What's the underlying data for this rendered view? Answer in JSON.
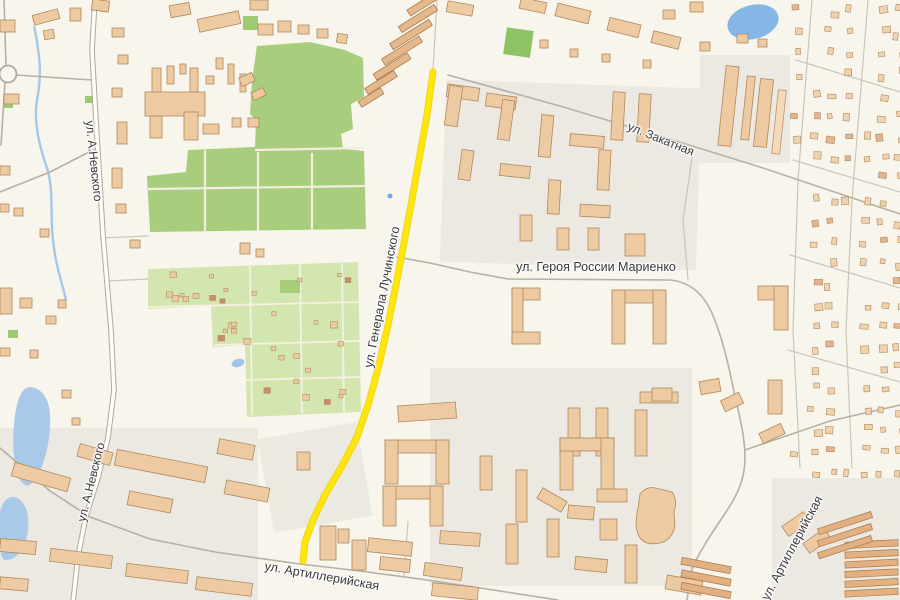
{
  "map": {
    "type": "street-map",
    "palette": {
      "background": "#f8f5ec",
      "residential_tint": "#ebe9e2",
      "park_green": "#a8cd7c",
      "allotment_green": "#d4e6b0",
      "water_blue": "#a9c9e9",
      "building_fill": "#eecaa3",
      "building_stroke": "#b08a5c",
      "road_casing": "#b0a99d",
      "route_highlight": "#ffe400",
      "label_color": "#3a3a3a"
    },
    "highlighted_route": {
      "street": "ул. Генерала Лучинского",
      "color": "#ffe400"
    },
    "street_labels": [
      {
        "id": "a-nevskogo-north",
        "text": "ул. А.Невского",
        "x": 94,
        "y": 161,
        "rotation": 84,
        "font_size": 12
      },
      {
        "id": "a-nevskogo-south",
        "text": "ул. А.Невского",
        "x": 91,
        "y": 482,
        "rotation": -76,
        "font_size": 12
      },
      {
        "id": "generala-luchinskogo",
        "text": "ул. Генерала Лучинского",
        "x": 382,
        "y": 297,
        "rotation": -79,
        "font_size": 12.5
      },
      {
        "id": "zakatnaya",
        "text": "ул. Закатная",
        "x": 661,
        "y": 139,
        "rotation": 22,
        "font_size": 12
      },
      {
        "id": "geroya-rossii-marienko",
        "text": "ул. Героя России Мариенко",
        "x": 596,
        "y": 267,
        "rotation": 0,
        "font_size": 12.5
      },
      {
        "id": "artilleriyskaya-west",
        "text": "ул. Артиллерийская",
        "x": 322,
        "y": 576,
        "rotation": 10,
        "font_size": 12.5
      },
      {
        "id": "artilleriyskaya-east",
        "text": "ул. Артиллерийская",
        "x": 792,
        "y": 548,
        "rotation": -62,
        "font_size": 12.5
      }
    ]
  }
}
